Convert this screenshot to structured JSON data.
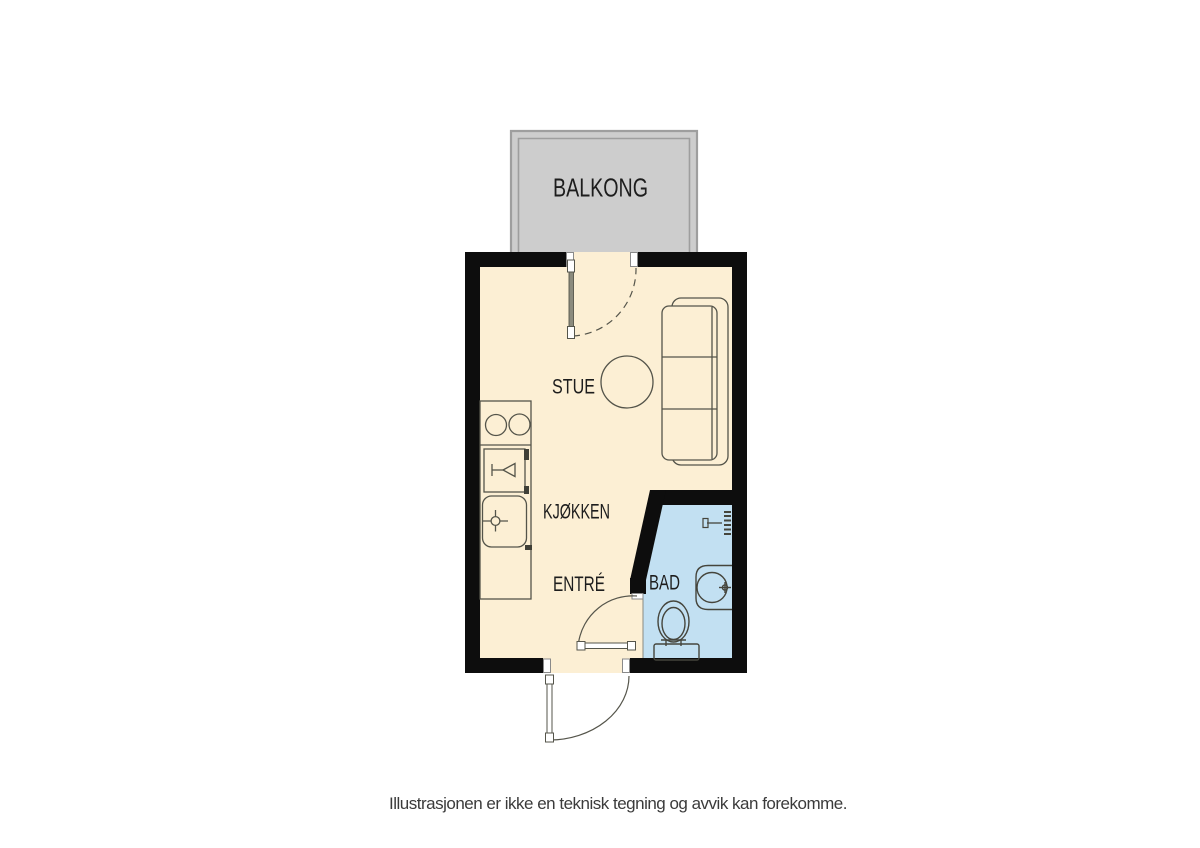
{
  "colors": {
    "wall": "#0d0d0d",
    "floor": "#fcefd4",
    "bathroom_floor": "#c2e0f2",
    "balcony": "#cdcdcd",
    "balcony_border": "#9e9e9e",
    "outline": "#54544a",
    "fixture_outline": "#45453c",
    "label_text": "#1d1d1d",
    "caption_text": "#3b3b3b"
  },
  "rooms": {
    "balcony": {
      "label": "BALKONG"
    },
    "living": {
      "label": "STUE"
    },
    "kitchen": {
      "label": "KJØKKEN"
    },
    "entry": {
      "label": "ENTRÉ"
    },
    "bathroom": {
      "label": "BAD"
    }
  },
  "fixtures": [
    "balcony-door",
    "entrance-door",
    "bathroom-door",
    "kitchen-counter",
    "cooktop",
    "dishwasher",
    "kitchen-sink",
    "sofa",
    "round-table",
    "toilet",
    "bathroom-sink",
    "shower-valve"
  ],
  "caption": "Illustrasjonen er ikke en teknisk tegning og avvik kan forekomme."
}
